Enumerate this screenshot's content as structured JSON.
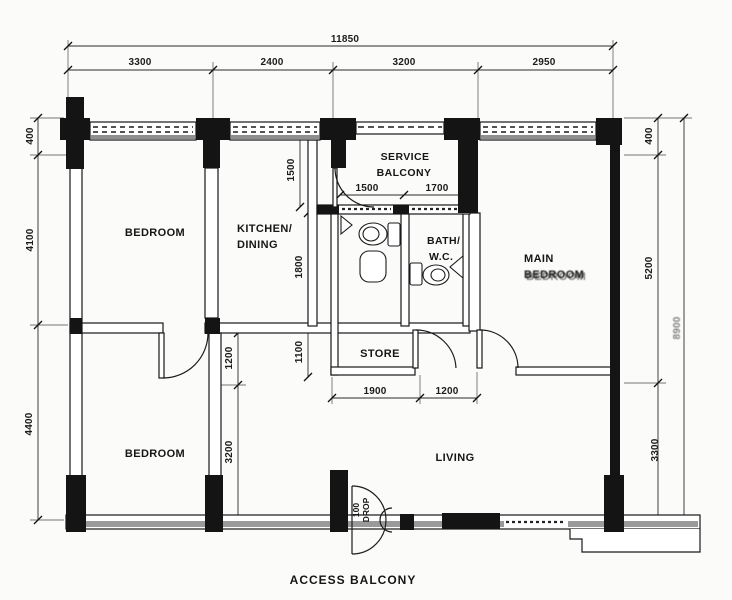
{
  "drawing": {
    "type": "apartment floor plan",
    "background": "#fbfbf9",
    "ink": "#141414",
    "sill_gray": "#8f8f8f"
  },
  "rooms": {
    "bedroom_top": "BEDROOM",
    "kitchen_line1": "KITCHEN/",
    "kitchen_line2": "DINING",
    "service_line1": "SERVICE",
    "service_line2": "BALCONY",
    "bath_line1": "BATH/",
    "bath_line2": "W.C.",
    "main_line1": "MAIN",
    "main_line2": "BEDROOM",
    "store": "STORE",
    "living": "LIVING",
    "bedroom_bottom": "BEDROOM",
    "access_balcony": "ACCESS  BALCONY"
  },
  "dims": {
    "overall_width": "11850",
    "top_segments": [
      "3300",
      "2400",
      "3200",
      "2950"
    ],
    "left_side": [
      "400",
      "4100",
      "4400"
    ],
    "right_side": [
      "400",
      "5200",
      "3300"
    ],
    "right_total": "8900",
    "service_balcony": [
      "1500",
      "1700"
    ],
    "store_bottom": [
      "1900",
      "1200"
    ],
    "balcony_depth": "1500",
    "bath_depth": "1800",
    "store_depth": "1100",
    "bedroom2_door_offset": "1200",
    "bedroom2_wall": "3200"
  },
  "notes": {
    "drop_value": "100",
    "drop_word": "DROP"
  }
}
